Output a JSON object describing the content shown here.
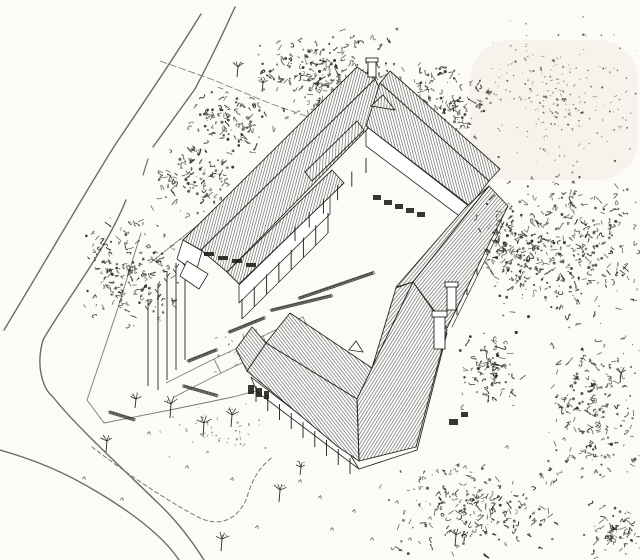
{
  "drawing": {
    "canvas": {
      "width": 640,
      "height": 560
    },
    "colors": {
      "paper": "#fcfbf7",
      "ink": "#28261f",
      "hatch": "#45423a",
      "road": "#6e6b63",
      "minor": "#7a776e",
      "window": "#1c1a15",
      "wash": "#efede4"
    },
    "washes": [
      {
        "name": "scan-shading-top-right",
        "x": 470,
        "y": 40,
        "w": 168,
        "h": 140,
        "o": 0.55
      }
    ],
    "hatch_patterns": [
      {
        "id": "hNW",
        "rot": 15,
        "gap": 2.6
      },
      {
        "id": "hNE",
        "rot": -15,
        "gap": 2.6
      },
      {
        "id": "hSE",
        "rot": 40,
        "gap": 2.7
      },
      {
        "id": "hA1",
        "rot": 32,
        "gap": 2.7
      },
      {
        "id": "hA2",
        "rot": -38,
        "gap": 2.7
      },
      {
        "id": "hMon",
        "rot": 4,
        "gap": 3.0
      }
    ],
    "ground_lines": [
      {
        "name": "road-upper-left-far-edge",
        "d": "M201,14 C178,52 140,108 117,142 C96,174 44,264 4,330",
        "w": 1.4,
        "c": "road"
      },
      {
        "name": "road-upper-left-near-edge",
        "d": "M235,7 C221,38 204,72 195,89 L153,147",
        "w": 1.4,
        "c": "road"
      },
      {
        "name": "road-near-edge-dashes",
        "d": "M148,159 L143,175",
        "w": 1.2,
        "c": "road"
      },
      {
        "name": "road-bend-inner-edge",
        "d": "M126,200 C105,252 62,306 43,340 C35,368 44,390 53,397 C74,424 122,468 158,503 C176,520 192,541 204,560",
        "w": 1.4,
        "c": "road"
      },
      {
        "name": "road-lower-outer-edge",
        "d": "M0,450 C32,459 63,471 99,493 C134,514 163,536 179,560",
        "w": 1.4,
        "c": "road"
      },
      {
        "name": "fence-west",
        "d": "M141,233 L116,314 L87,400 L104,423 L170,410 L233,397 L263,389",
        "w": 0.9,
        "c": "minor"
      },
      {
        "name": "fence-north",
        "d": "M160,61 L211,79 L269,103 L334,126",
        "w": 0.8,
        "c": "minor",
        "dash": "7,3"
      },
      {
        "name": "path-behind-west-gable",
        "d": "M150,263 L198,225",
        "w": 0.8,
        "c": "minor"
      },
      {
        "name": "driveway-loop",
        "d": "M92,447 C122,470 165,500 200,518 C226,530 243,512 248,494 C253,478 261,465 273,457",
        "w": 1.0,
        "c": "minor",
        "dash": "4,3"
      },
      {
        "name": "walkway-quad-1",
        "d": "M214,359 L263,336 L269,350 L221,373 Z",
        "w": 0.8,
        "c": "minor"
      },
      {
        "name": "walkway-quad-2",
        "d": "M263,336 L303,317 L309,331 L269,350",
        "w": 0.8,
        "c": "minor"
      },
      {
        "name": "walkway-quad-3",
        "d": "M166,383 L214,359 L221,373 L174,397",
        "w": 0.8,
        "c": "minor"
      },
      {
        "name": "walkway-spur-1",
        "d": "M243,334 L247,372",
        "w": 0.8,
        "c": "minor"
      },
      {
        "name": "walkway-spur-2",
        "d": "M256,329 L259,367",
        "w": 0.8,
        "c": "minor"
      }
    ],
    "walls": [
      {
        "name": "west-gable-wall",
        "pts": "183,240 202,251 196,272 177,259"
      },
      {
        "name": "west-porch-gable-wall",
        "pts": "187,261 208,274 199,289 180,276"
      },
      {
        "name": "northwest-porch-wall",
        "pts": "239,285 330,196 330,214 239,303"
      },
      {
        "name": "northeast-courtyard-wall",
        "pts": "366,126 470,207 470,224 366,146"
      },
      {
        "name": "pavilion-southwest-wall",
        "pts": "251,377 349,453 359,469 257,392"
      }
    ],
    "roof_faces": [
      {
        "name": "northwest-wing-outer-roof",
        "pts": "183,240 357,67 375,79 201,250",
        "pat": "hNW"
      },
      {
        "name": "northwest-wing-inner-roof",
        "pts": "201,250 375,79 389,107 227,272",
        "pat": "hNW"
      },
      {
        "name": "northwest-veranda-roof",
        "pts": "227,272 332,170 344,183 239,284",
        "pat": "hNW"
      },
      {
        "name": "northwest-monitor-roof",
        "pts": "305,172 357,121 364,130 312,181",
        "pat": "hMon"
      },
      {
        "name": "northeast-wing-outer-roof",
        "pts": "380,83 390,71 500,169 489,181",
        "pat": "hNE"
      },
      {
        "name": "northeast-wing-inner-roof",
        "pts": "380,83 489,181 470,206 366,126",
        "pat": "hNE"
      },
      {
        "name": "southeast-wing-outer-roof",
        "pts": "489,186 508,206 447,328 413,282",
        "pat": "hSE"
      },
      {
        "name": "southeast-wing-inner-roof",
        "pts": "489,186 465,208 396,287 413,282",
        "pat": "hSE"
      },
      {
        "name": "pavilion-arm1-courtyard-sliver",
        "pts": "413,282 396,288 372,368 357,399",
        "pat": "hSE"
      },
      {
        "name": "pavilion-arm1-southeast-roof",
        "pts": "413,282 447,330 416,447 359,461 357,399",
        "pat": "hA1"
      },
      {
        "name": "pavilion-arm2-northeast-roof",
        "pts": "266,343 290,313 372,368 357,399",
        "pat": "hA2"
      },
      {
        "name": "pavilion-arm2-southwest-roof",
        "pts": "266,343 357,399 359,461 337,446 247,371",
        "pat": "hA2"
      },
      {
        "name": "pavilion-west-hip-roof",
        "pts": "266,343 252,327 236,349 247,371",
        "pat": "hA2"
      },
      {
        "name": "north-junction-gable",
        "pts": "371,106 383,95 395,110",
        "pat": "hMon"
      }
    ],
    "building_lines": [
      {
        "name": "pavilion-hip-edge",
        "d": "M357,399 L359,461",
        "w": 0.9,
        "c": "ink"
      },
      {
        "name": "southeast-eave-fascia",
        "d": "M504,222 L452,327",
        "w": 0.7,
        "c": "ink"
      },
      {
        "name": "pavilion-southeast-wall-edge",
        "d": "M359,469 L417,450 L447,333",
        "w": 0.9,
        "c": "ink"
      }
    ],
    "dormer": {
      "name": "pavilion-roof-dormer",
      "pts": "349,350 356,341 363,352"
    },
    "post_rows": [
      {
        "name": "west-veranda-posts",
        "from": [
          242,
          299
        ],
        "to": [
          328,
          213
        ],
        "count": 8,
        "h": 20,
        "base": true
      },
      {
        "name": "courtyard-veranda-posts",
        "from": [
          295,
          226
        ],
        "to": [
          366,
          158
        ],
        "count": 6,
        "h": 15,
        "base": false
      },
      {
        "name": "pavilion-veranda-posts",
        "from": [
          256,
          386
        ],
        "to": [
          350,
          458
        ],
        "count": 9,
        "h": 16,
        "base": false
      },
      {
        "name": "southeast-wall-posts",
        "from": [
          497,
          228
        ],
        "to": [
          457,
          308
        ],
        "count": 5,
        "h": 7,
        "base": false
      }
    ],
    "window_groups": [
      {
        "name": "west-clerestory-windows",
        "rects": [
          [
            204,
            252,
            10,
            4
          ],
          [
            218,
            256,
            10,
            4
          ],
          [
            232,
            259,
            10,
            4
          ],
          [
            246,
            263,
            10,
            4
          ]
        ]
      },
      {
        "name": "northeast-courtyard-windows",
        "rects": [
          [
            373,
            195,
            8,
            5
          ],
          [
            384,
            200,
            8,
            5
          ],
          [
            395,
            204,
            8,
            5
          ],
          [
            406,
            208,
            8,
            5
          ],
          [
            417,
            212,
            8,
            5
          ]
        ]
      },
      {
        "name": "pavilion-west-windows",
        "rects": [
          [
            248,
            385,
            6,
            9
          ],
          [
            256,
            388,
            6,
            9
          ],
          [
            264,
            391,
            5,
            8
          ]
        ]
      },
      {
        "name": "pavilion-southeast-windows",
        "rects": [
          [
            449,
            419,
            9,
            6
          ],
          [
            461,
            412,
            7,
            5
          ]
        ]
      }
    ],
    "chimneys": [
      {
        "name": "chimney-southeast",
        "x": 434,
        "y": 315,
        "w": 11,
        "h": 34,
        "cap": [
          432,
          311,
          15,
          6
        ]
      },
      {
        "name": "chimney-east",
        "x": 447,
        "y": 286,
        "w": 9,
        "h": 24,
        "cap": [
          445,
          282,
          13,
          5
        ]
      },
      {
        "name": "chimney-north-apex",
        "x": 368,
        "y": 61,
        "w": 8,
        "h": 16,
        "cap": [
          366,
          58,
          12,
          4
        ]
      }
    ],
    "hedges": [
      {
        "name": "hedge-walkway-1",
        "seg": [
          187,
          362,
          217,
          350
        ]
      },
      {
        "name": "hedge-walkway-2",
        "seg": [
          228,
          333,
          265,
          318
        ]
      },
      {
        "name": "hedge-walkway-3",
        "seg": [
          270,
          311,
          332,
          296
        ]
      },
      {
        "name": "hedge-courtyard",
        "seg": [
          298,
          299,
          374,
          273
        ]
      },
      {
        "name": "hedge-fence-corner",
        "seg": [
          108,
          412,
          134,
          420
        ]
      },
      {
        "name": "hedge-walkway-south",
        "seg": [
          182,
          386,
          217,
          396
        ]
      }
    ],
    "poles": [
      [
        148,
        300,
        386
      ],
      [
        158,
        283,
        390
      ],
      [
        167,
        272,
        380
      ],
      [
        176,
        263,
        370
      ],
      [
        185,
        256,
        360
      ]
    ],
    "small_trees": [
      [
        170,
        418,
        14
      ],
      [
        203,
        436,
        13
      ],
      [
        231,
        427,
        12
      ],
      [
        106,
        452,
        11
      ],
      [
        279,
        502,
        12
      ],
      [
        221,
        551,
        12
      ],
      [
        135,
        408,
        9
      ],
      [
        237,
        77,
        10
      ],
      [
        262,
        92,
        9
      ],
      [
        455,
        546,
        11
      ],
      [
        300,
        475,
        8
      ],
      [
        620,
        383,
        10
      ]
    ],
    "grass_tufts": [
      [
        298,
        482
      ],
      [
        318,
        498
      ],
      [
        352,
        512
      ],
      [
        395,
        503
      ],
      [
        428,
        519
      ],
      [
        185,
        468
      ],
      [
        255,
        528
      ],
      [
        147,
        434
      ],
      [
        463,
        468
      ],
      [
        505,
        448
      ],
      [
        330,
        530
      ],
      [
        370,
        540
      ],
      [
        120,
        500
      ],
      [
        82,
        479
      ],
      [
        540,
        478
      ],
      [
        562,
        440
      ],
      [
        408,
        540
      ],
      [
        230,
        480
      ]
    ],
    "tree_clusters": [
      {
        "name": "trees-top-center",
        "cx": 330,
        "cy": 78,
        "rx": 78,
        "ry": 52,
        "n": 260,
        "style": "scribble",
        "seed": 11,
        "front": false
      },
      {
        "name": "trees-north",
        "cx": 445,
        "cy": 105,
        "rx": 48,
        "ry": 50,
        "n": 150,
        "style": "scribble",
        "seed": 24,
        "front": false
      },
      {
        "name": "trees-top-left",
        "cx": 232,
        "cy": 122,
        "rx": 42,
        "ry": 40,
        "n": 100,
        "style": "scribble",
        "seed": 12,
        "front": false
      },
      {
        "name": "trees-left",
        "cx": 134,
        "cy": 272,
        "rx": 54,
        "ry": 56,
        "n": 170,
        "style": "scribble",
        "seed": 13,
        "front": false
      },
      {
        "name": "trees-left-upper",
        "cx": 196,
        "cy": 180,
        "rx": 46,
        "ry": 40,
        "n": 110,
        "style": "scribble",
        "seed": 14,
        "front": false
      },
      {
        "name": "trees-top-right-stipple",
        "cx": 556,
        "cy": 96,
        "rx": 86,
        "ry": 80,
        "n": 230,
        "style": "stipple",
        "seed": 15,
        "front": false
      },
      {
        "name": "shrubs-center-left",
        "cx": 215,
        "cy": 432,
        "rx": 62,
        "ry": 30,
        "n": 45,
        "style": "sparse",
        "seed": 21,
        "front": false
      },
      {
        "name": "shrubs-courtyard-entrance",
        "cx": 252,
        "cy": 352,
        "rx": 40,
        "ry": 26,
        "n": 35,
        "style": "sparse",
        "seed": 22,
        "front": false
      },
      {
        "name": "trees-right-dense",
        "cx": 568,
        "cy": 250,
        "rx": 76,
        "ry": 82,
        "n": 300,
        "style": "scribble",
        "seed": 16,
        "front": true
      },
      {
        "name": "trees-east-corner",
        "cx": 510,
        "cy": 248,
        "rx": 40,
        "ry": 56,
        "n": 130,
        "style": "scribble",
        "seed": 17,
        "front": true
      },
      {
        "name": "trees-right-mid",
        "cx": 592,
        "cy": 408,
        "rx": 56,
        "ry": 80,
        "n": 190,
        "style": "scribble",
        "seed": 18,
        "front": true
      },
      {
        "name": "trees-pavilion-east",
        "cx": 492,
        "cy": 370,
        "rx": 34,
        "ry": 42,
        "n": 90,
        "style": "scribble",
        "seed": 23,
        "front": true
      },
      {
        "name": "trees-bottom",
        "cx": 470,
        "cy": 509,
        "rx": 96,
        "ry": 50,
        "n": 210,
        "style": "scribble",
        "seed": 19,
        "front": true
      },
      {
        "name": "trees-bottom-right",
        "cx": 616,
        "cy": 532,
        "rx": 34,
        "ry": 28,
        "n": 70,
        "style": "scribble",
        "seed": 20,
        "front": true
      }
    ]
  }
}
